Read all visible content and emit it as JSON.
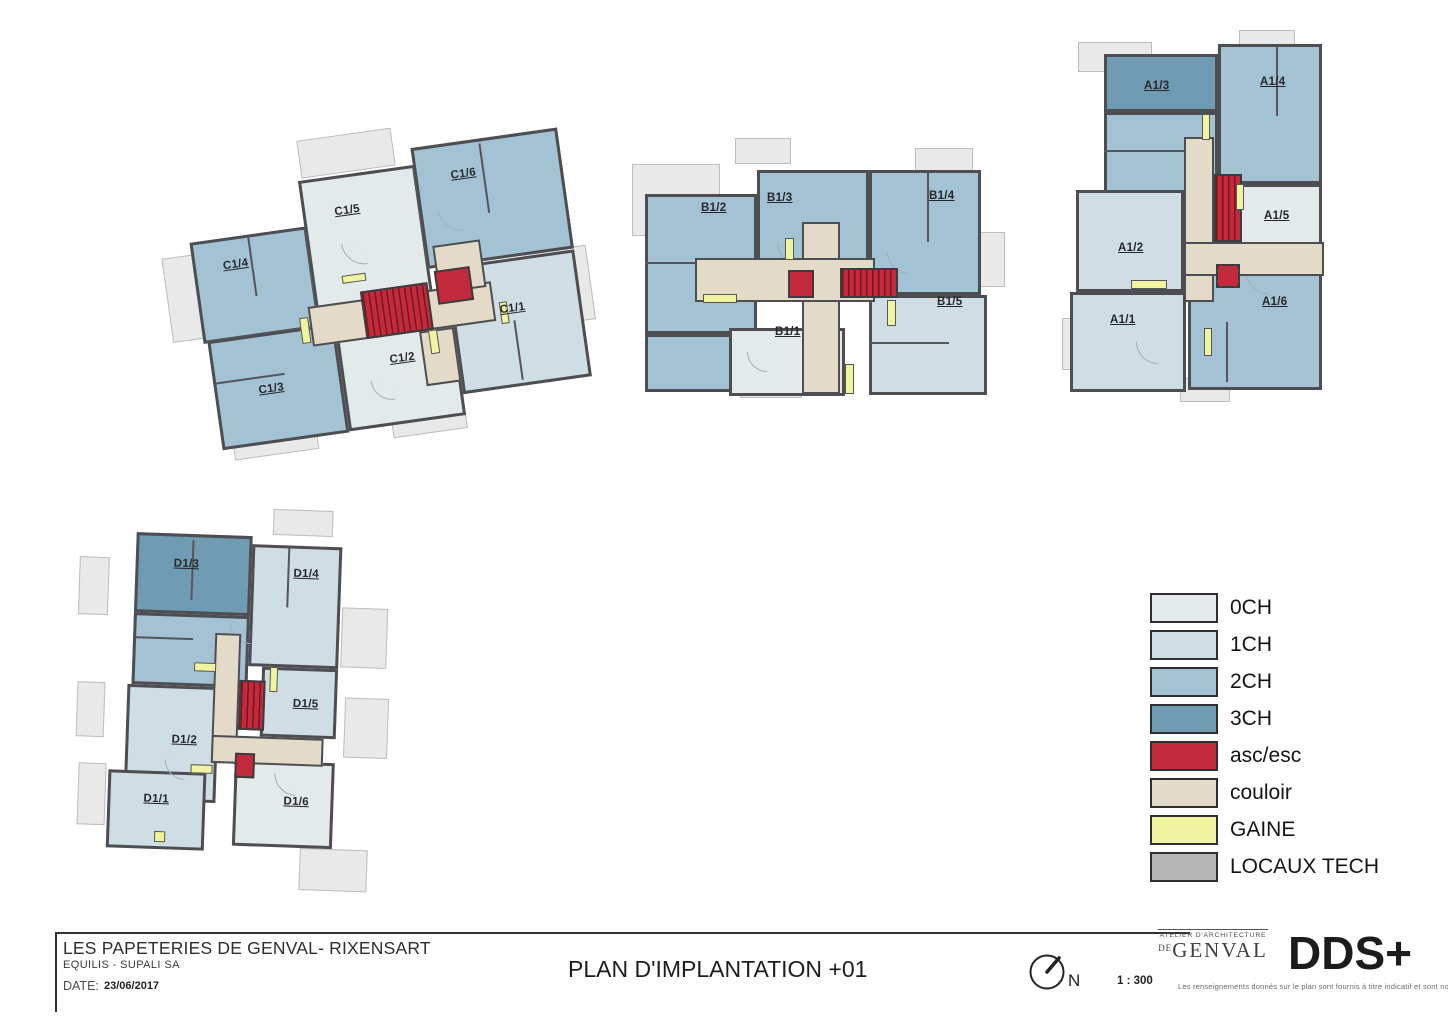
{
  "titleblock": {
    "project_title": "LES PAPETERIES DE GENVAL- RIXENSART",
    "client": "EQUILIS - SUPALI SA",
    "date_label": "DATE:",
    "date_value": "23/06/2017",
    "plan_title": "PLAN D'IMPLANTATION +01",
    "scale": "1 : 300",
    "north_label": "N",
    "architect_logo_line1": "ATELIER D'ARCHITECTURE",
    "architect_logo_de": "DE",
    "architect_logo_name": "GENVAL",
    "firm_logo": "DDS+",
    "disclaimer": "Les renseignements donnés sur le plan sont fournis à titre indicatif et sont non contractuels"
  },
  "legend": {
    "items": [
      {
        "label": "0CH",
        "color": "#e3eaea"
      },
      {
        "label": "1CH",
        "color": "#cfdde4"
      },
      {
        "label": "2CH",
        "color": "#a3c2d4"
      },
      {
        "label": "3CH",
        "color": "#6f9cb3"
      },
      {
        "label": "asc/esc",
        "color": "#c32b3d"
      },
      {
        "label": "couloir",
        "color": "#e4dac8"
      },
      {
        "label": "GAINE",
        "color": "#f1f49e"
      },
      {
        "label": "LOCAUX TECH",
        "color": "#b5b5b5"
      }
    ]
  },
  "palette": {
    "wall": "#4d4d52",
    "terrace": "#e9e9e9"
  },
  "buildings": {
    "c": {
      "units": {
        "u1": "C1/1",
        "u2": "C1/2",
        "u3": "C1/3",
        "u4": "C1/4",
        "u5": "C1/5",
        "u6": "C1/6"
      }
    },
    "b": {
      "units": {
        "u1": "B1/1",
        "u2": "B1/2",
        "u3": "B1/3",
        "u4": "B1/4",
        "u5": "B1/5"
      }
    },
    "a": {
      "units": {
        "u1": "A1/1",
        "u2": "A1/2",
        "u3": "A1/3",
        "u4": "A1/4",
        "u5": "A1/5",
        "u6": "A1/6"
      }
    },
    "d": {
      "units": {
        "u1": "D1/1",
        "u2": "D1/2",
        "u3": "D1/3",
        "u4": "D1/4",
        "u5": "D1/5",
        "u6": "D1/6"
      }
    }
  }
}
